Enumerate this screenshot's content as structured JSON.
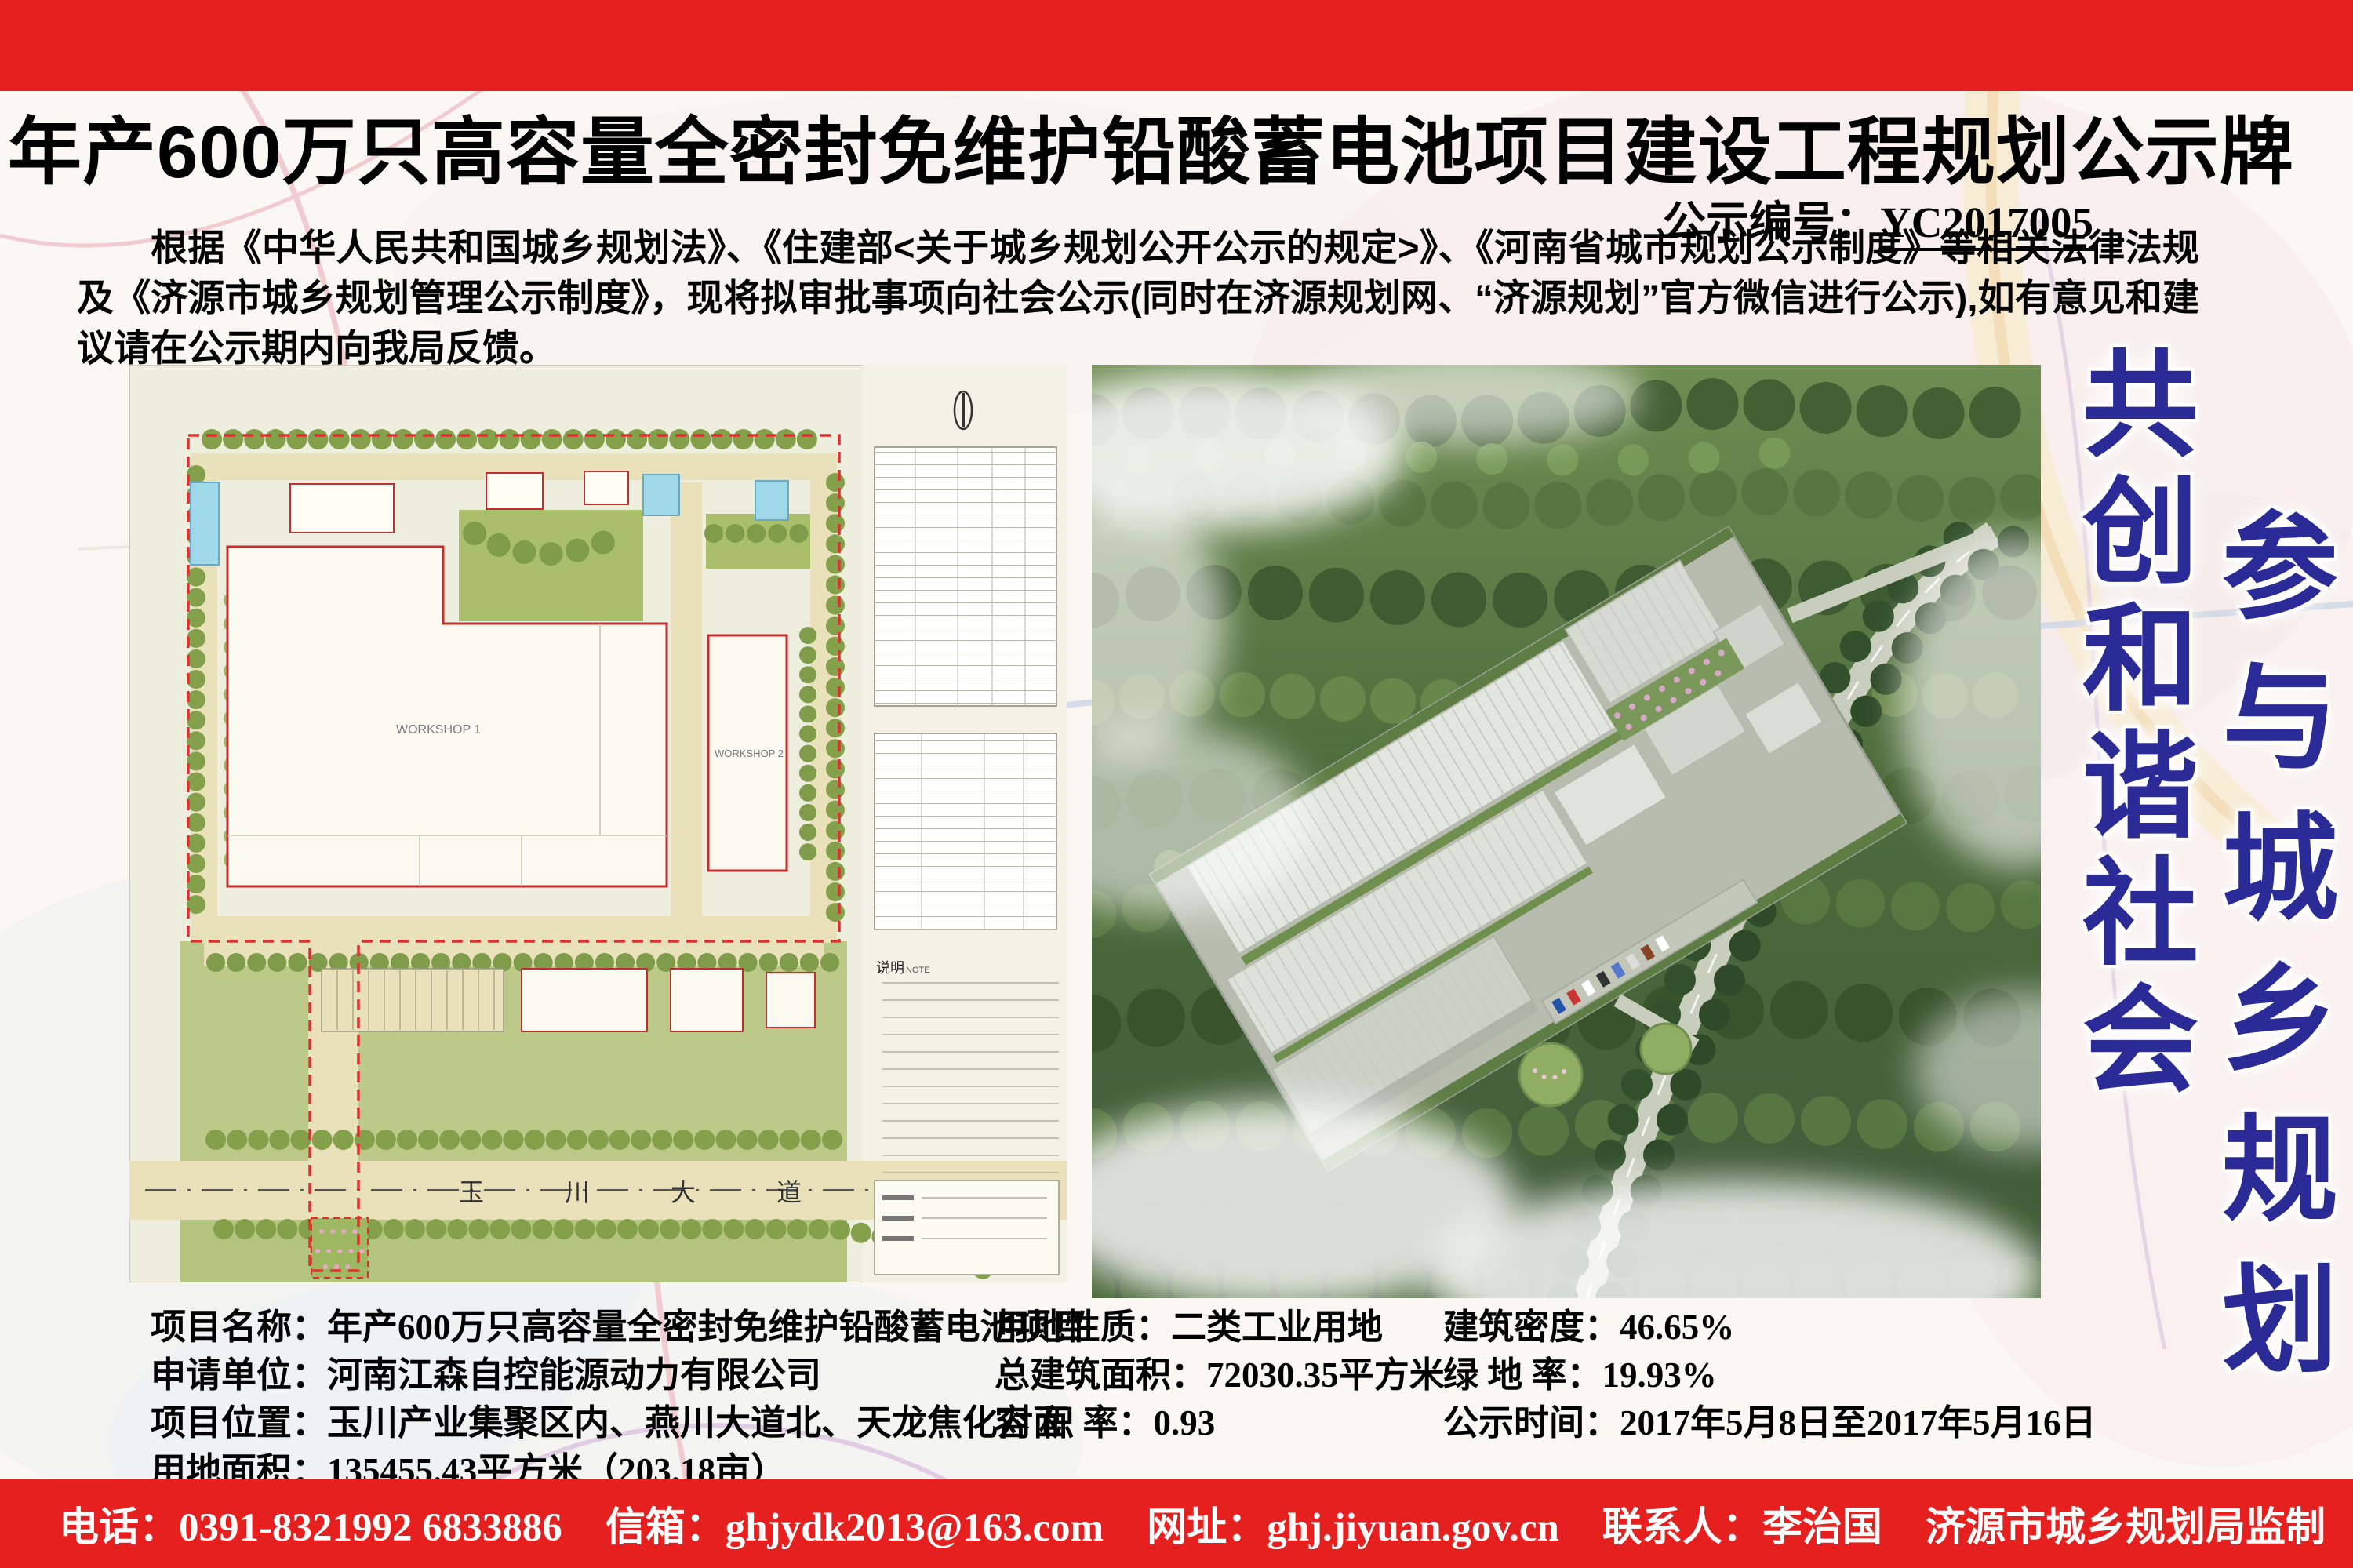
{
  "colors": {
    "bar_red": "#e5201e",
    "slogan_blue": "#2b2b97",
    "title_black": "#000000",
    "plan_lawn_green": "#bcc988",
    "plan_road_cream": "#e9e1ba",
    "boundary_red": "#e03030",
    "forest_green": "#4a6b3a",
    "building_grey": "#dde1d8"
  },
  "header": {
    "title": "年产600万只高容量全密封免维护铅酸蓄电池项目建设工程规划公示牌 （批前）",
    "notice_label": "公示编号：",
    "notice_number": "YC2017005"
  },
  "intro": "根据《中华人民共和国城乡规划法》、《住建部<关于城乡规划公开公示的规定>》、《河南省城市规划公示制度》等相关法律法规及《济源市城乡规划管理公示制度》，现将拟审批事项向社会公示(同时在济源规划网、“济源规划”官方微信进行公示),如有意见和建议请在公示期内向我局反馈。",
  "site_plan": {
    "road_label_1": "玉",
    "road_label_2": "川",
    "road_label_3": "大",
    "road_label_4": "道",
    "workshop1_label": "WORKSHOP 1",
    "workshop2_label": "WORKSHOP 2",
    "note_label": "说明",
    "note_en": "NOTE"
  },
  "slogans": {
    "first": "共创和谐社会",
    "second": "参与城乡规划"
  },
  "details": {
    "col1": [
      {
        "label": "项目名称：",
        "value": "年产600万只高容量全密封免维护铅酸蓄电池项目"
      },
      {
        "label": "申请单位：",
        "value": "河南江森自控能源动力有限公司"
      },
      {
        "label": "项目位置：",
        "value": "玉川产业集聚区内、燕川大道北、天龙焦化对面"
      },
      {
        "label": "用地面积：",
        "value": "135455.43平方米（203.18亩）"
      }
    ],
    "col2": [
      {
        "label": "用地性质：",
        "value": "二类工业用地"
      },
      {
        "label": "总建筑面积：",
        "value": "72030.35平方米"
      },
      {
        "label": "容 积 率：",
        "value": "0.93"
      }
    ],
    "col3": [
      {
        "label": "建筑密度：",
        "value": "46.65%"
      },
      {
        "label": "绿 地 率：",
        "value": "19.93%"
      },
      {
        "label": "公示时间：",
        "value": "2017年5月8日至2017年5月16日"
      }
    ]
  },
  "footer": {
    "phone": "电话：0391-8321992 6833886",
    "email": "信箱：ghjydk2013@163.com",
    "web": "网址：ghj.jiyuan.gov.cn",
    "contact": "联系人：李治国",
    "producer": "济源市城乡规划局监制"
  }
}
